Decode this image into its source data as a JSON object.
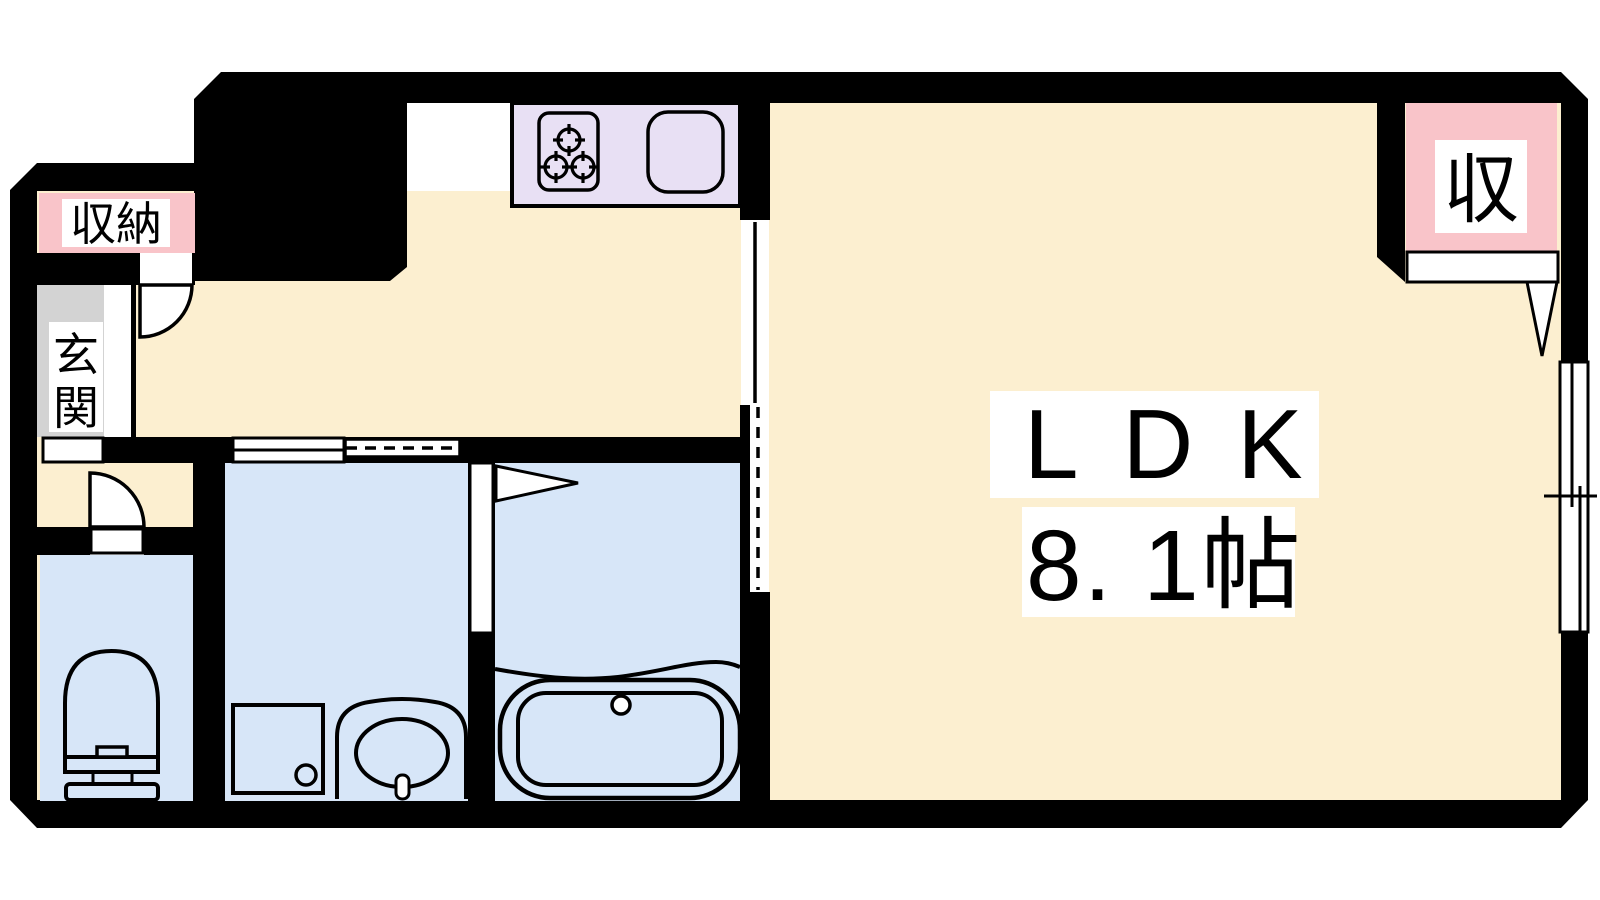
{
  "plan": {
    "kind": "apartment floor plan",
    "labels": {
      "ldk": "LDK",
      "ldk_size": "8. 1帖",
      "entrance_full": "玄関",
      "entrance_1": "玄",
      "entrance_2": "関",
      "hall_storage": "収納",
      "ldk_storage": "収"
    },
    "rooms": [
      {
        "id": "ldk",
        "label": "LDK",
        "size": "8. 1帖"
      },
      {
        "id": "entrance",
        "label": "玄関"
      },
      {
        "id": "hall-storage",
        "label": "収納"
      },
      {
        "id": "ldk-storage",
        "label": "収"
      },
      {
        "id": "kitchen"
      },
      {
        "id": "toilet"
      },
      {
        "id": "washroom"
      },
      {
        "id": "bathroom"
      }
    ],
    "colors": {
      "wall": "#000000",
      "floor_main": "#FCEFD0",
      "floor_wet": "#D7E6F8",
      "counter": "#E8E0F4",
      "storage": "#F9C4C9",
      "entrance": "#D3D3D3",
      "text": "#000000",
      "background": "#FFFFFF"
    },
    "fixtures": [
      "kitchen-stove-3-burner",
      "kitchen-sink",
      "bathtub",
      "toilet-bowl",
      "washing-machine-pan",
      "wash-basin"
    ],
    "doors": [
      "hall-storage-swing-door",
      "toilet-swing-door",
      "bathroom-folding-door",
      "ldk-closet-door",
      "hall-ldk-sliding-door"
    ],
    "windows": [
      "washroom-window",
      "washroom-dashed-opening",
      "ldk-side-sliding-window"
    ]
  }
}
